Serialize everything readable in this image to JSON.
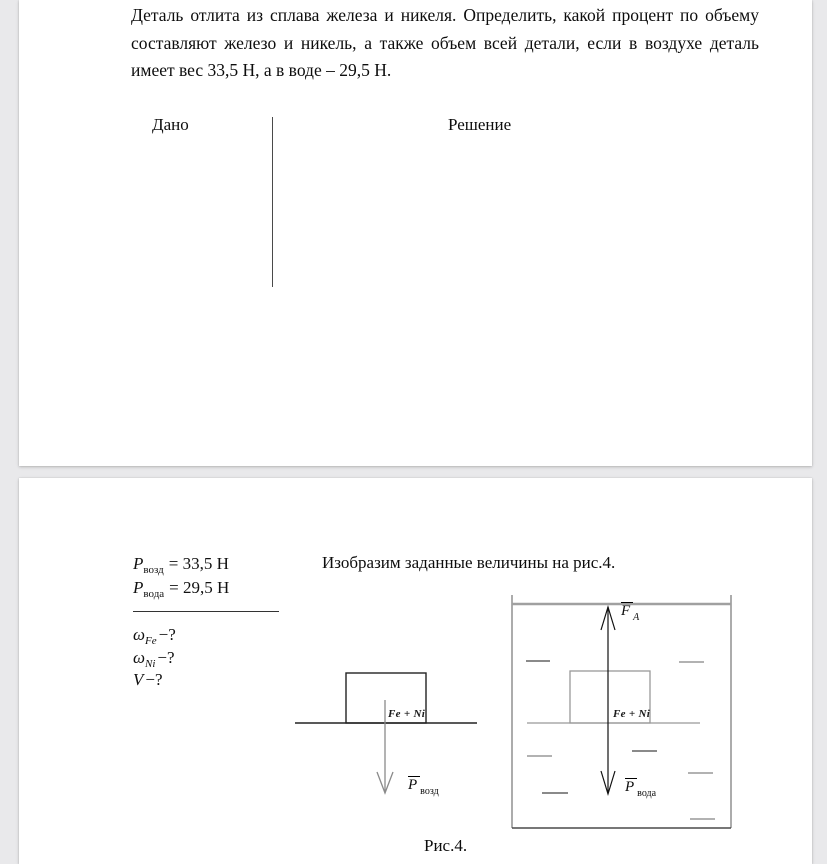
{
  "colors": {
    "canvas_bg": "#e9e9eb",
    "page_bg": "#ffffff",
    "text": "#111111",
    "diagram_dark": "#222222",
    "diagram_gray": "#909090"
  },
  "page1": {
    "problem_text": "Деталь отлита из сплава железа и никеля. Определить, какой процент по объему составляют железо и никель, а также объем всей детали, если в воздухе деталь имеет вес 33,5 Н, а в воде – 29,5 Н.",
    "given_header": "Дано",
    "solution_header": "Решение"
  },
  "page2": {
    "given": [
      {
        "sym": "P",
        "sub": "возд",
        "val": "= 33,5 Н"
      },
      {
        "sym": "P",
        "sub": "вода",
        "val": "= 29,5 Н"
      }
    ],
    "unknowns": [
      {
        "sym": "ω",
        "sub": "Fe",
        "val": "−?"
      },
      {
        "sym": "ω",
        "sub": "Ni",
        "val": "−?"
      },
      {
        "sym": "V",
        "sub": "",
        "val": "−?"
      }
    ],
    "solution_intro": "Изобразим заданные величины на рис.4.",
    "figure": {
      "air_diagram": {
        "body_label": "Fe + Ni",
        "weight_label": {
          "sym": "P",
          "sub": "возд"
        }
      },
      "water_diagram": {
        "body_label": "Fe + Ni",
        "buoyancy_label": {
          "sym": "F",
          "sub": "A"
        },
        "weight_label": {
          "sym": "P",
          "sub": "вода"
        }
      },
      "caption": "Рис.4."
    }
  }
}
